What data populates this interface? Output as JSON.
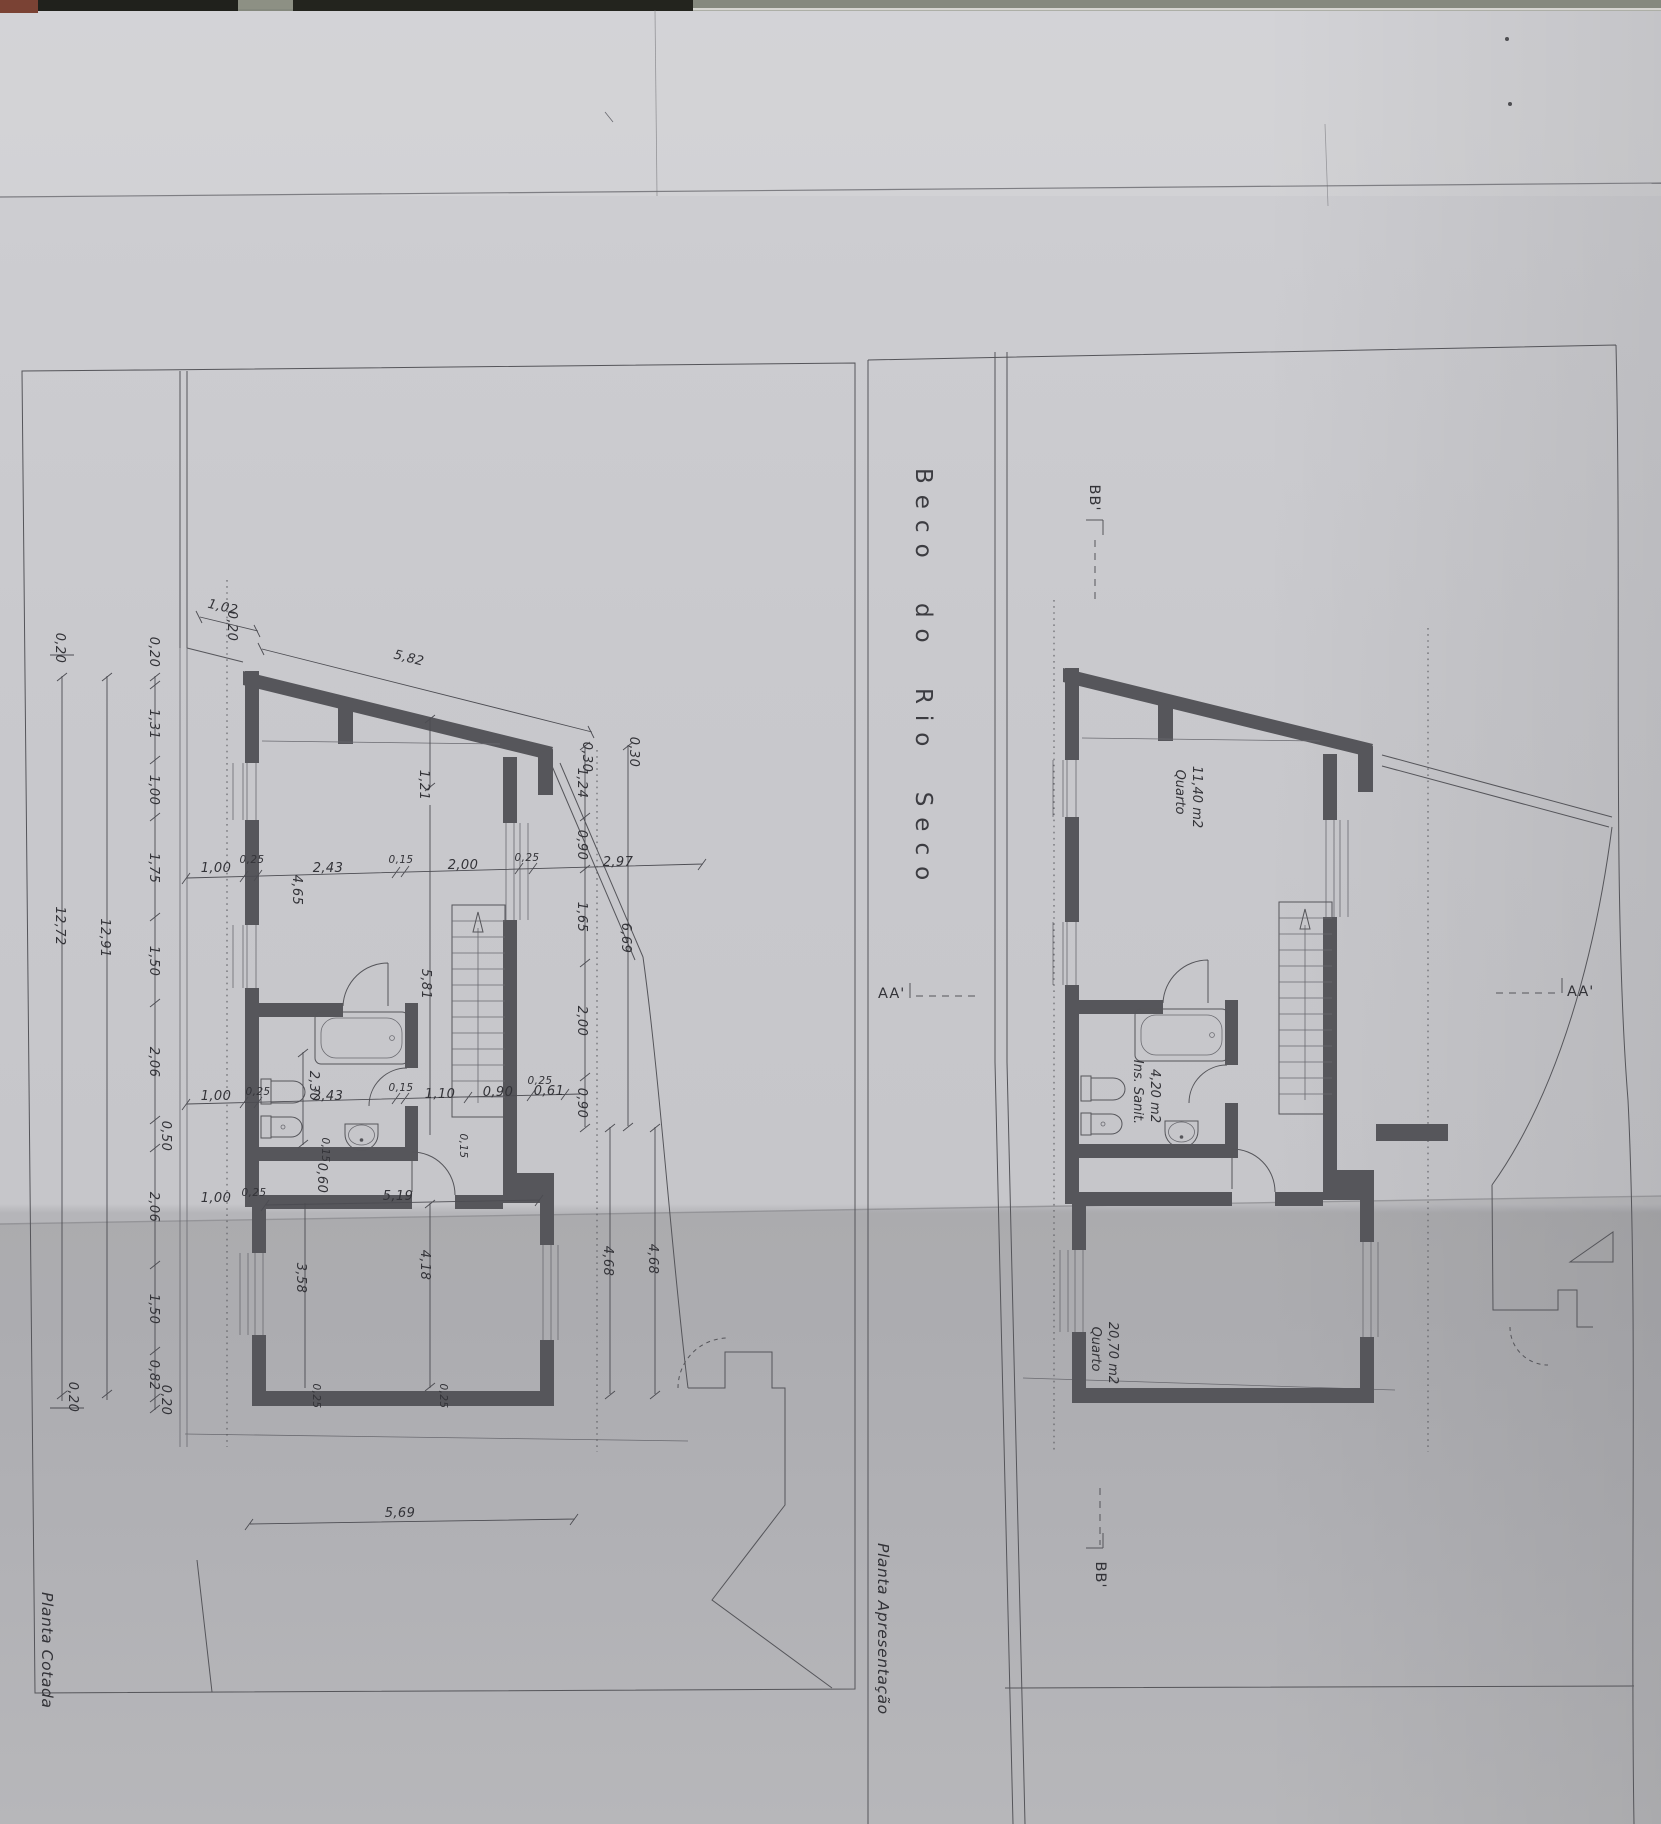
{
  "street_label": "Beco do Rio Seco",
  "left_plan": {
    "title": "Planta Cotada",
    "chain_left": [
      "0,20",
      "1,31",
      "1,00",
      "1,75",
      "1,50",
      "2,06",
      "0,50",
      "2,06",
      "1,50",
      "0,82",
      "0,20"
    ],
    "totals": [
      "12,91",
      "12,72"
    ],
    "outer_ticks": [
      "0,20",
      "0,20"
    ],
    "top_dims": [
      "1,02",
      "5,82",
      "0,20"
    ],
    "row_upper": [
      "1,00",
      "0,25",
      "4,65",
      "2,43",
      "0,15",
      "2,00",
      "0,25",
      "2,97"
    ],
    "col_right": [
      "0,30",
      "0,30",
      "1,24",
      "0,90",
      "1,65",
      "2,00",
      "0,90",
      "6,69",
      "4,68",
      "4,68"
    ],
    "row_lower": [
      "1,00",
      "0,25",
      "2,30",
      "2,43",
      "0,15",
      "1,10",
      "0,90",
      "0,61",
      "0,25"
    ],
    "interior": [
      "1,21",
      "5,81",
      "0,15",
      "0,60",
      "0,15",
      "5,19",
      "1,00",
      "0,25",
      "4,18",
      "3,58",
      "0,25",
      "0,25",
      "5,69"
    ]
  },
  "right_plan": {
    "title": "Planta Apresentação",
    "rooms": [
      {
        "name": "Quarto",
        "area": "11,40 m2"
      },
      {
        "name": "Ins. Sanit.",
        "area": "4,20 m2"
      },
      {
        "name": "Quarto",
        "area": "20,70 m2"
      }
    ],
    "sections": {
      "bb_top": "BB'",
      "bb_bottom": "BB'",
      "aa_left": "AA'",
      "aa_right": "AA'"
    }
  }
}
